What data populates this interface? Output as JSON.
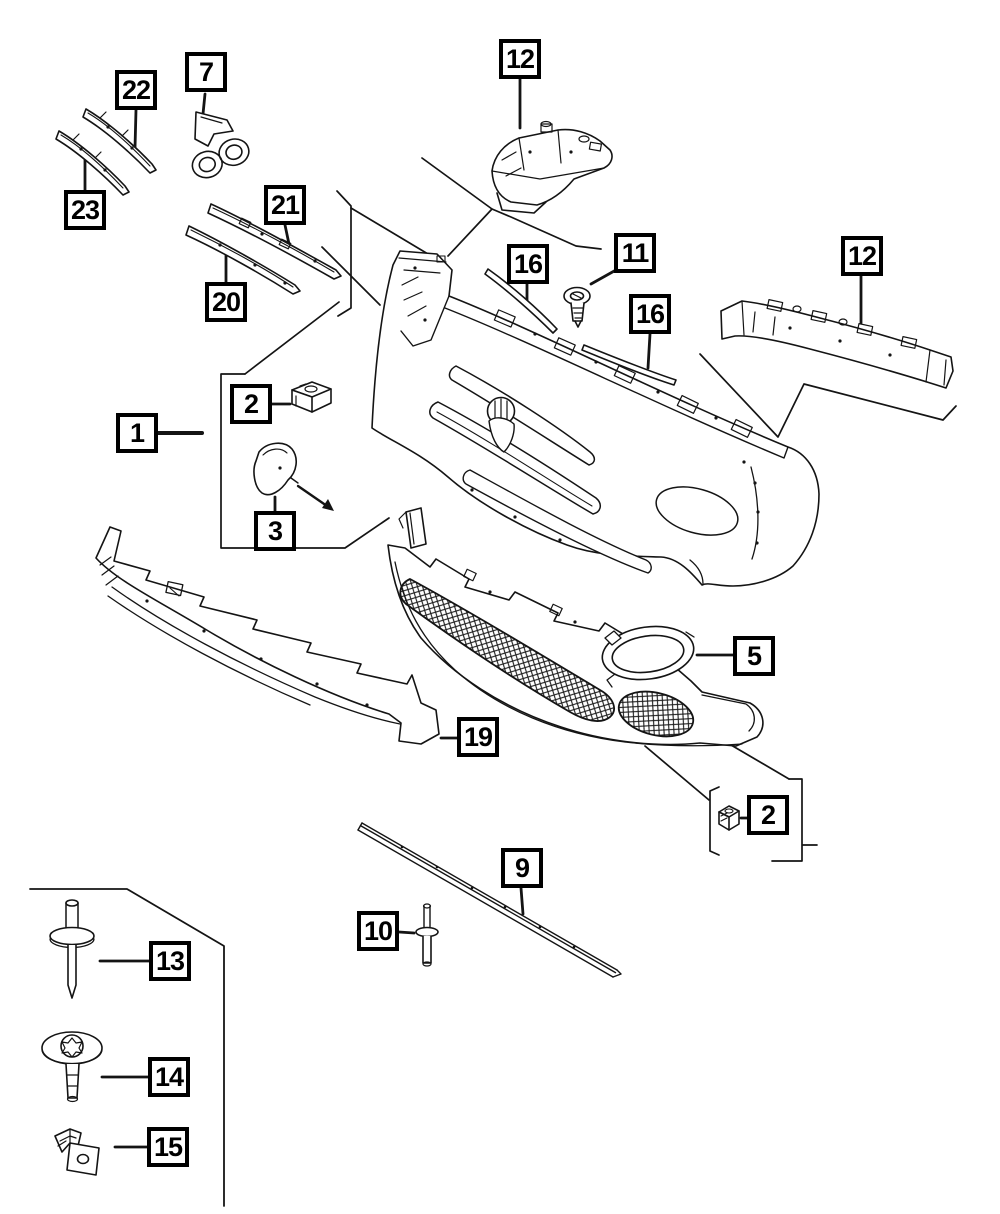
{
  "diagram": {
    "background": "#ffffff",
    "line_color": "#141414",
    "label_border": "#000000",
    "label_background": "#ffffff"
  },
  "callouts": [
    {
      "num": "22"
    },
    {
      "num": "7"
    },
    {
      "num": "23"
    },
    {
      "num": "21"
    },
    {
      "num": "20"
    },
    {
      "num": "12"
    },
    {
      "num": "16"
    },
    {
      "num": "11"
    },
    {
      "num": "16"
    },
    {
      "num": "12"
    },
    {
      "num": "1"
    },
    {
      "num": "2"
    },
    {
      "num": "3"
    },
    {
      "num": "5"
    },
    {
      "num": "19"
    },
    {
      "num": "2"
    },
    {
      "num": "9"
    },
    {
      "num": "10"
    },
    {
      "num": "13"
    },
    {
      "num": "14"
    },
    {
      "num": "15"
    }
  ],
  "parts": [
    {
      "callout": "22",
      "icon": "trim-strip-icon"
    },
    {
      "callout": "23",
      "icon": "trim-strip-icon"
    },
    {
      "callout": "7",
      "icon": "badge-logo-icon"
    },
    {
      "callout": "21",
      "icon": "grille-molding-icon"
    },
    {
      "callout": "20",
      "icon": "grille-molding-icon"
    },
    {
      "callout": "12",
      "icon": "mounting-bracket-icon"
    },
    {
      "callout": "11",
      "icon": "screw-icon"
    },
    {
      "callout": "16",
      "icon": "gasket-strip-icon"
    },
    {
      "callout": "1",
      "icon": "upper-fascia-icon"
    },
    {
      "callout": "2",
      "icon": "clip-nut-icon"
    },
    {
      "callout": "3",
      "icon": "tow-hook-cover-icon"
    },
    {
      "callout": "5",
      "icon": "fog-lamp-bezel-icon"
    },
    {
      "callout": "19",
      "icon": "lower-valance-icon"
    },
    {
      "callout": "9",
      "icon": "sill-strip-icon"
    },
    {
      "callout": "10",
      "icon": "rivet-icon"
    },
    {
      "callout": "13",
      "icon": "rivet-icon"
    },
    {
      "callout": "14",
      "icon": "washer-bolt-icon"
    },
    {
      "callout": "15",
      "icon": "retainer-clip-icon"
    }
  ]
}
